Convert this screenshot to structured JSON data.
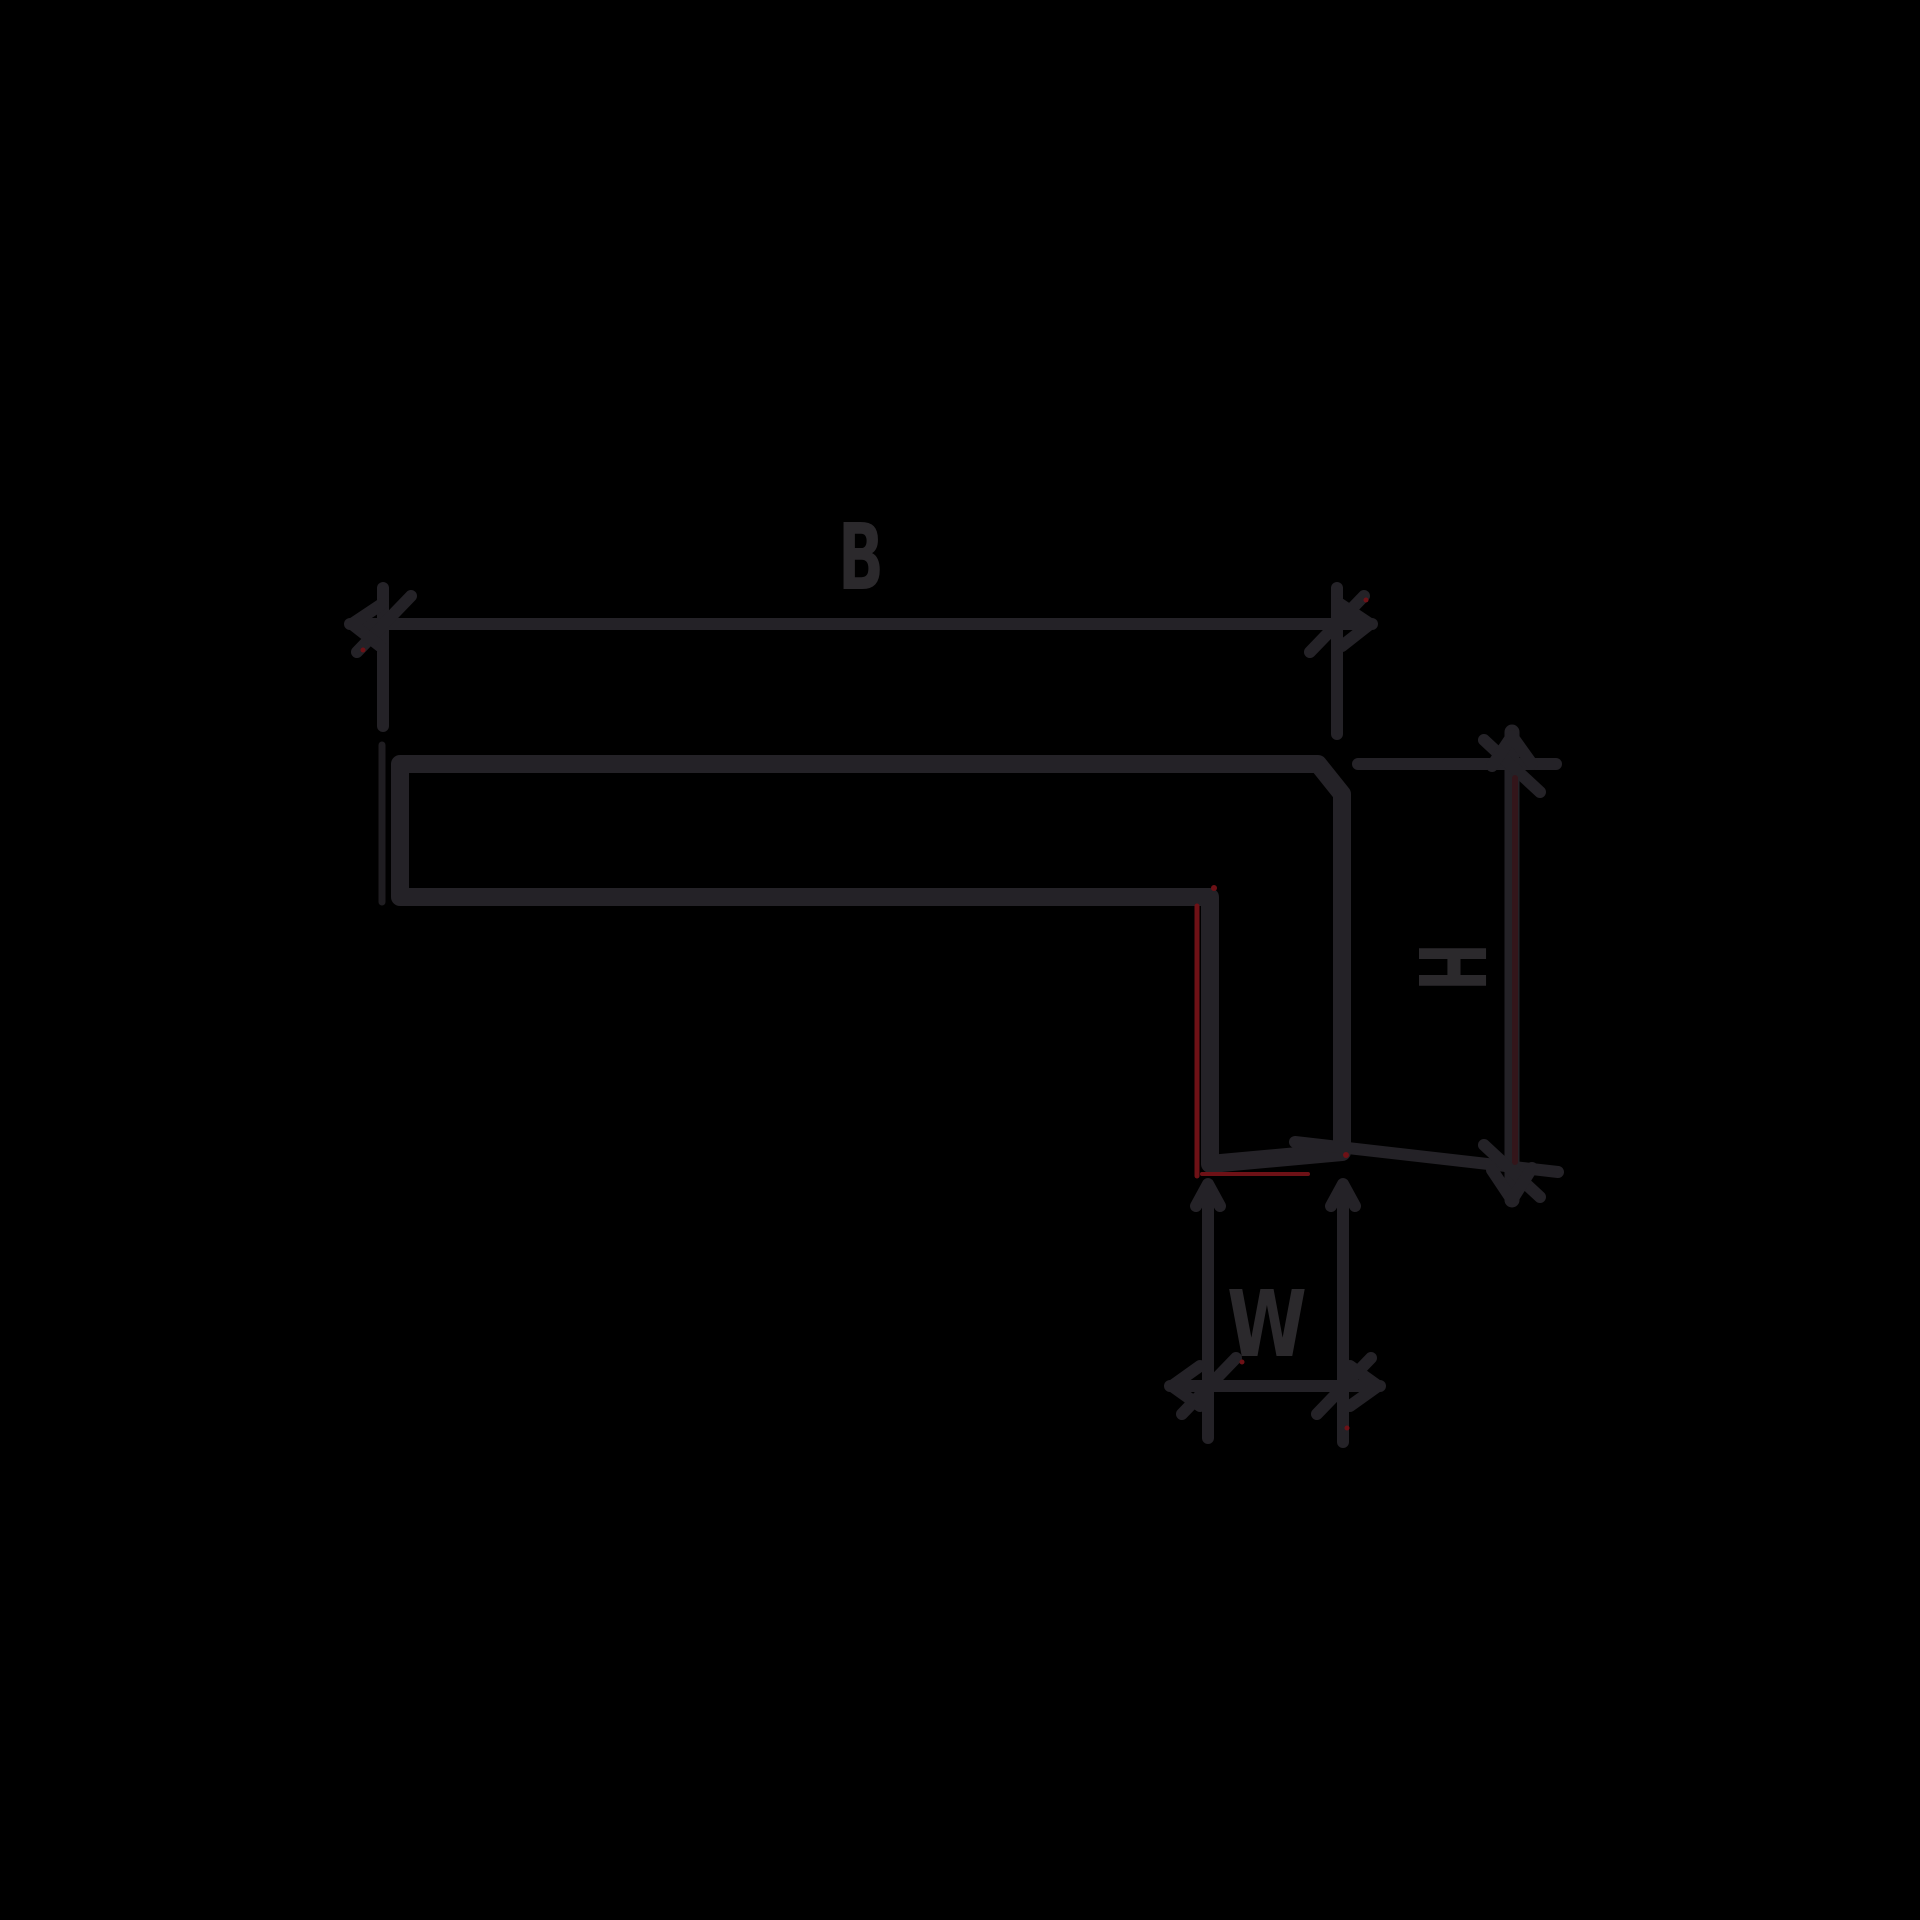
{
  "diagram": {
    "kind": "technical-profile-cross-section",
    "labels": {
      "top_width": "B",
      "right_height": "H",
      "bottom_width": "W"
    },
    "colors": {
      "background": "#000000",
      "line": "#242227",
      "label": "#2b292c",
      "accent": "#6e1116",
      "accent_soft": "#33151a"
    }
  }
}
